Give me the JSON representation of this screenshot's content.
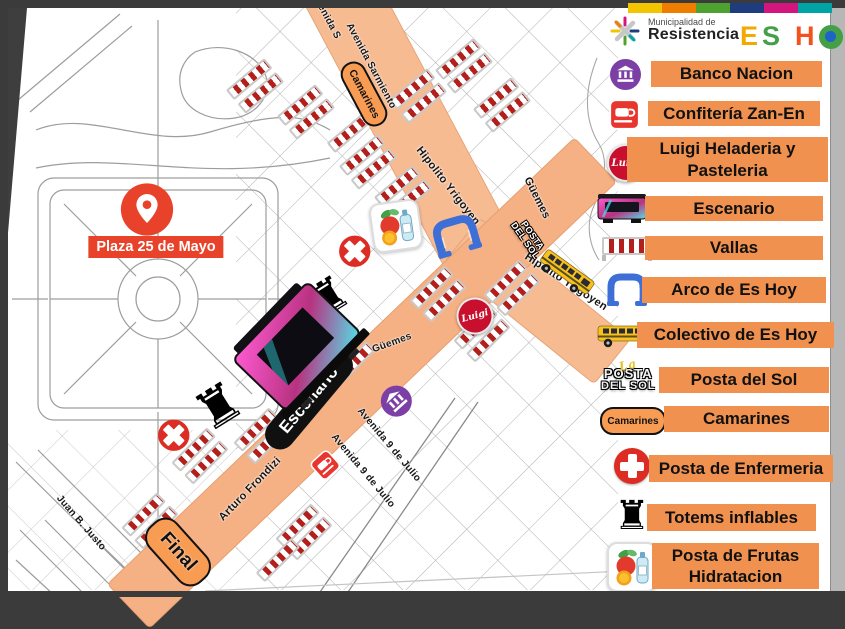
{
  "header": {
    "strip_colors": [
      "#F2C500",
      "#EF7D00",
      "#4CA32F",
      "#1F3C7E",
      "#D4157E",
      "#00A3A6"
    ],
    "municipality_line1": "Municipalidad de",
    "municipality_line2": "Resistencia",
    "event_logo": [
      {
        "ch": "E",
        "color": "#F2A900"
      },
      {
        "ch": "S",
        "color": "#43A047"
      },
      {
        "ch": "H",
        "color": "#F4511E"
      },
      {
        "ch": "O",
        "color": "#43A047",
        "inner": "#1E64C8"
      },
      {
        "ch": "Y",
        "color": "#F9A825"
      }
    ]
  },
  "legend": {
    "items": [
      {
        "icon": "bank-icon",
        "label": "Banco Nacion"
      },
      {
        "icon": "coffee-cup-icon",
        "label": "Confitería Zan-En"
      },
      {
        "icon": "luigi-badge-icon",
        "label": "Luigi Heladeria y",
        "label2": "Pasteleria"
      },
      {
        "icon": "stage-truck-icon",
        "label": "Escenario"
      },
      {
        "icon": "barrier-icon",
        "label": "Vallas"
      },
      {
        "icon": "arch-icon",
        "label": "Arco de Es Hoy"
      },
      {
        "icon": "bus-icon",
        "label": "Colectivo de Es Hoy"
      },
      {
        "icon": "posta-del-sol-logo",
        "label": "Posta del Sol"
      },
      {
        "icon": "camarines-pill-icon",
        "label": "Camarines"
      },
      {
        "icon": "medical-cross-icon",
        "label": "Posta de Enfermeria"
      },
      {
        "icon": "totem-icon",
        "label": "Totems inflables"
      },
      {
        "icon": "fruits-icon",
        "label": "Posta de Frutas",
        "label2": "Hidratacion"
      }
    ],
    "luigi_badge_text": "Luigi",
    "camarines_pill_text": "Camarines",
    "posta_sol_script": "La",
    "posta_sol_line1": "POSTA",
    "posta_sol_line2": "DEL SOL"
  },
  "map": {
    "plaza_marker_label": "Plaza 25 de Mayo",
    "route_pills": {
      "camarines": "Camarines",
      "escenario": "Escenario",
      "final": "Final"
    },
    "street_labels": [
      {
        "text": "Avenida S"
      },
      {
        "text": "Avenida Sarmiento"
      },
      {
        "text": "Hipolito Yrigoyen"
      },
      {
        "text": "Güemes"
      },
      {
        "text": "Hipolito Yrigoyen"
      },
      {
        "text": "Güemes"
      },
      {
        "text": "Avenida 9 de Julio"
      },
      {
        "text": "Avenida 9 de Julio"
      },
      {
        "text": "Arturo Frondizi"
      },
      {
        "text": "Juan B. Justo"
      }
    ],
    "luigi_badge_text": "Luigi",
    "posta_sol_line1": "POSTA",
    "posta_sol_line2": "DEL SOL"
  }
}
